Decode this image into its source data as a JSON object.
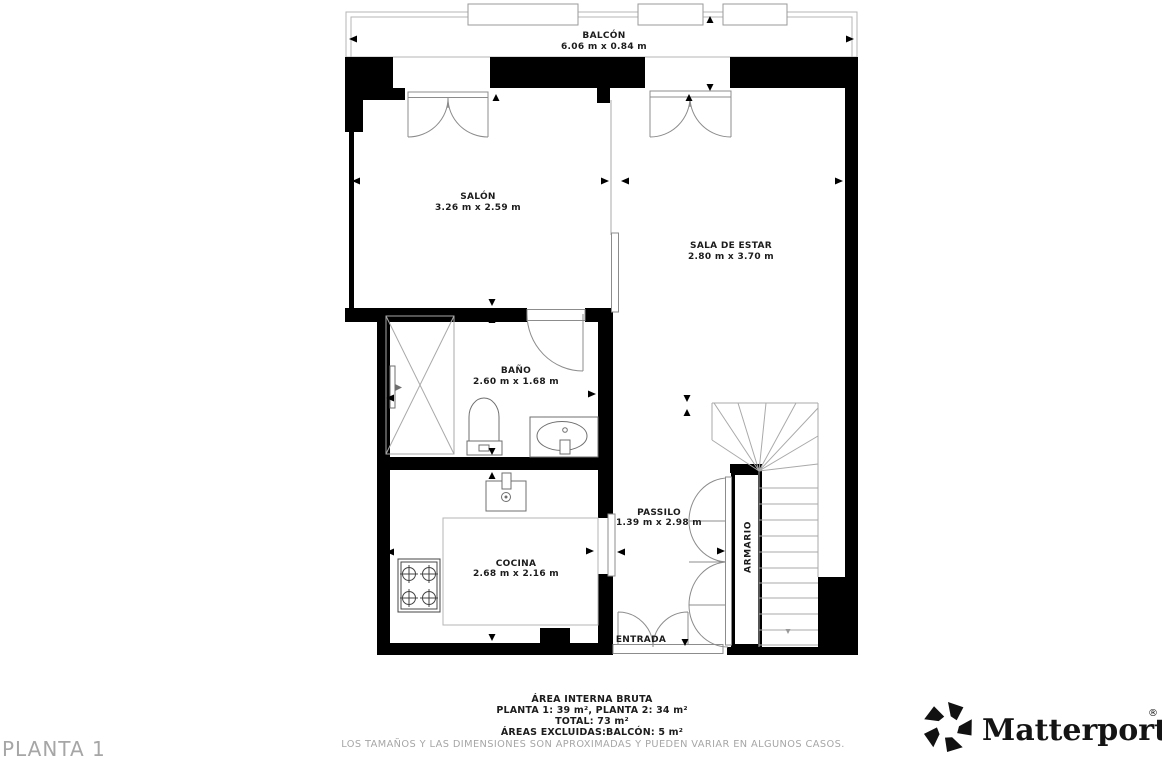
{
  "colors": {
    "wall": "#000000",
    "thin_line": "#8c8c8c",
    "label_text": "#1c1c1c",
    "muted_text": "#a6a6a6"
  },
  "floor_label": "PLANTA 1",
  "rooms": {
    "balcon": {
      "name": "BALCÓN",
      "dims": "6.06 m x 0.84 m"
    },
    "salon": {
      "name": "SALÓN",
      "dims": "3.26 m x 2.59 m"
    },
    "sala_de_estar": {
      "name": "SALA DE ESTAR",
      "dims": "2.80 m x 3.70 m"
    },
    "bano": {
      "name": "BAÑO",
      "dims": "2.60 m x 1.68 m"
    },
    "passilo": {
      "name": "PASSILO",
      "dims": "1.39 m x 2.98 m"
    },
    "cocina": {
      "name": "COCINA",
      "dims": "2.68 m x 2.16 m"
    },
    "entrada": {
      "name": "ENTRADA"
    },
    "armario": {
      "name": "ARMARIO"
    }
  },
  "area_summary": {
    "title": "ÁREA INTERNA BRUTA",
    "line_plantas": "PLANTA 1: 39 m², PLANTA 2: 34 m²",
    "line_total": "TOTAL: 73 m²",
    "line_excluded": "ÁREAS EXCLUIDAS:BALCÓN: 5 m²",
    "disclaimer": "LOS TAMAÑOS Y LAS DIMENSIONES SON APROXIMADAS Y PUEDEN VARIAR EN ALGUNOS CASOS."
  },
  "branding": {
    "logo_text": "Matterport",
    "registered_mark": "®"
  }
}
